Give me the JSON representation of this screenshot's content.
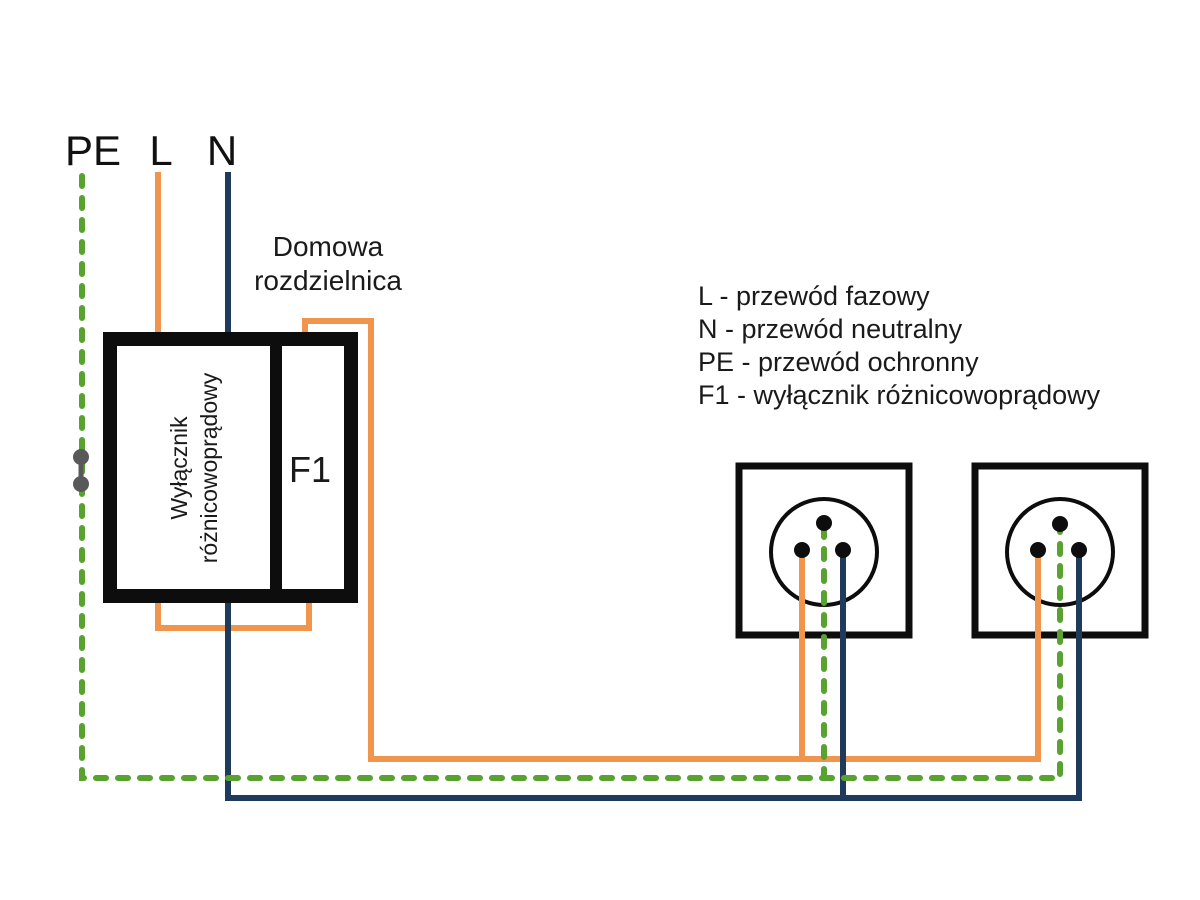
{
  "wire_labels": {
    "pe": "PE",
    "l": "L",
    "n": "N"
  },
  "panel": {
    "title": "Domowa\nrozdzielnica",
    "rcd_label": "Wyłącznik\nróżnicowoprądowy",
    "fuse_label": "F1"
  },
  "legend": {
    "items": [
      "L - przewód fazowy",
      "N - przewód neutralny",
      "PE - przewód ochronny",
      "F1 - wyłącznik różnicowoprądowy"
    ]
  },
  "colors": {
    "l_wire": "#F0954E",
    "n_wire": "#1F3B5C",
    "pe_wire": "#58A32F",
    "panel_outline": "#0D0D0D",
    "junction_gray": "#595959"
  }
}
